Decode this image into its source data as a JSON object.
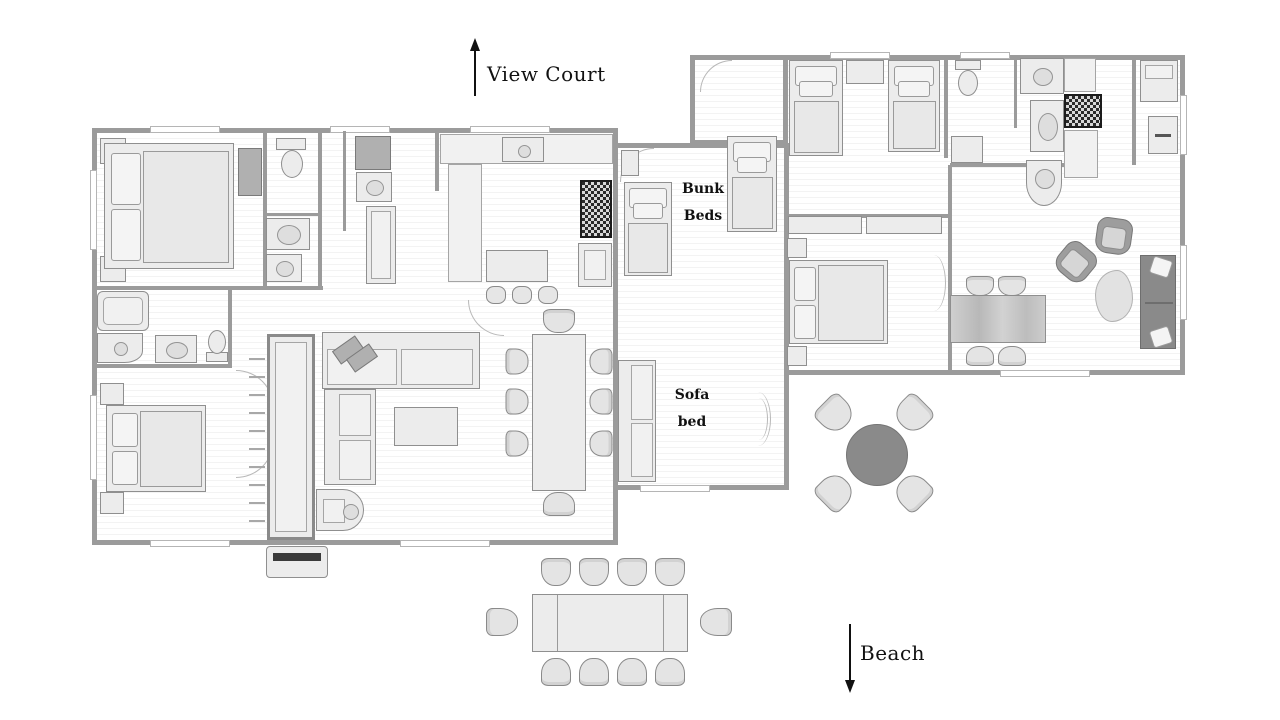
{
  "annotations": {
    "view_court": {
      "text": "View Court",
      "arrow": "up"
    },
    "beach": {
      "text": "Beach",
      "arrow": "down"
    },
    "bunk_beds": {
      "line1": "Bunk",
      "line2": "Beds"
    },
    "sofa_bed": {
      "line1": "Sofa",
      "line2": "bed"
    }
  },
  "icons": {
    "view_court_arrow": "↑",
    "beach_arrow": "↓"
  },
  "colors": {
    "wall": "#9b9b9b",
    "floor_stripe": "#f3f3f3",
    "furniture_fill": "#ececec",
    "furniture_stroke": "#8f8f8f",
    "dark_appliance": "#2a2a2a",
    "outdoor_table": "#8a8a8a",
    "dark_sofa": "#8a8a8a",
    "text": "#111111"
  }
}
